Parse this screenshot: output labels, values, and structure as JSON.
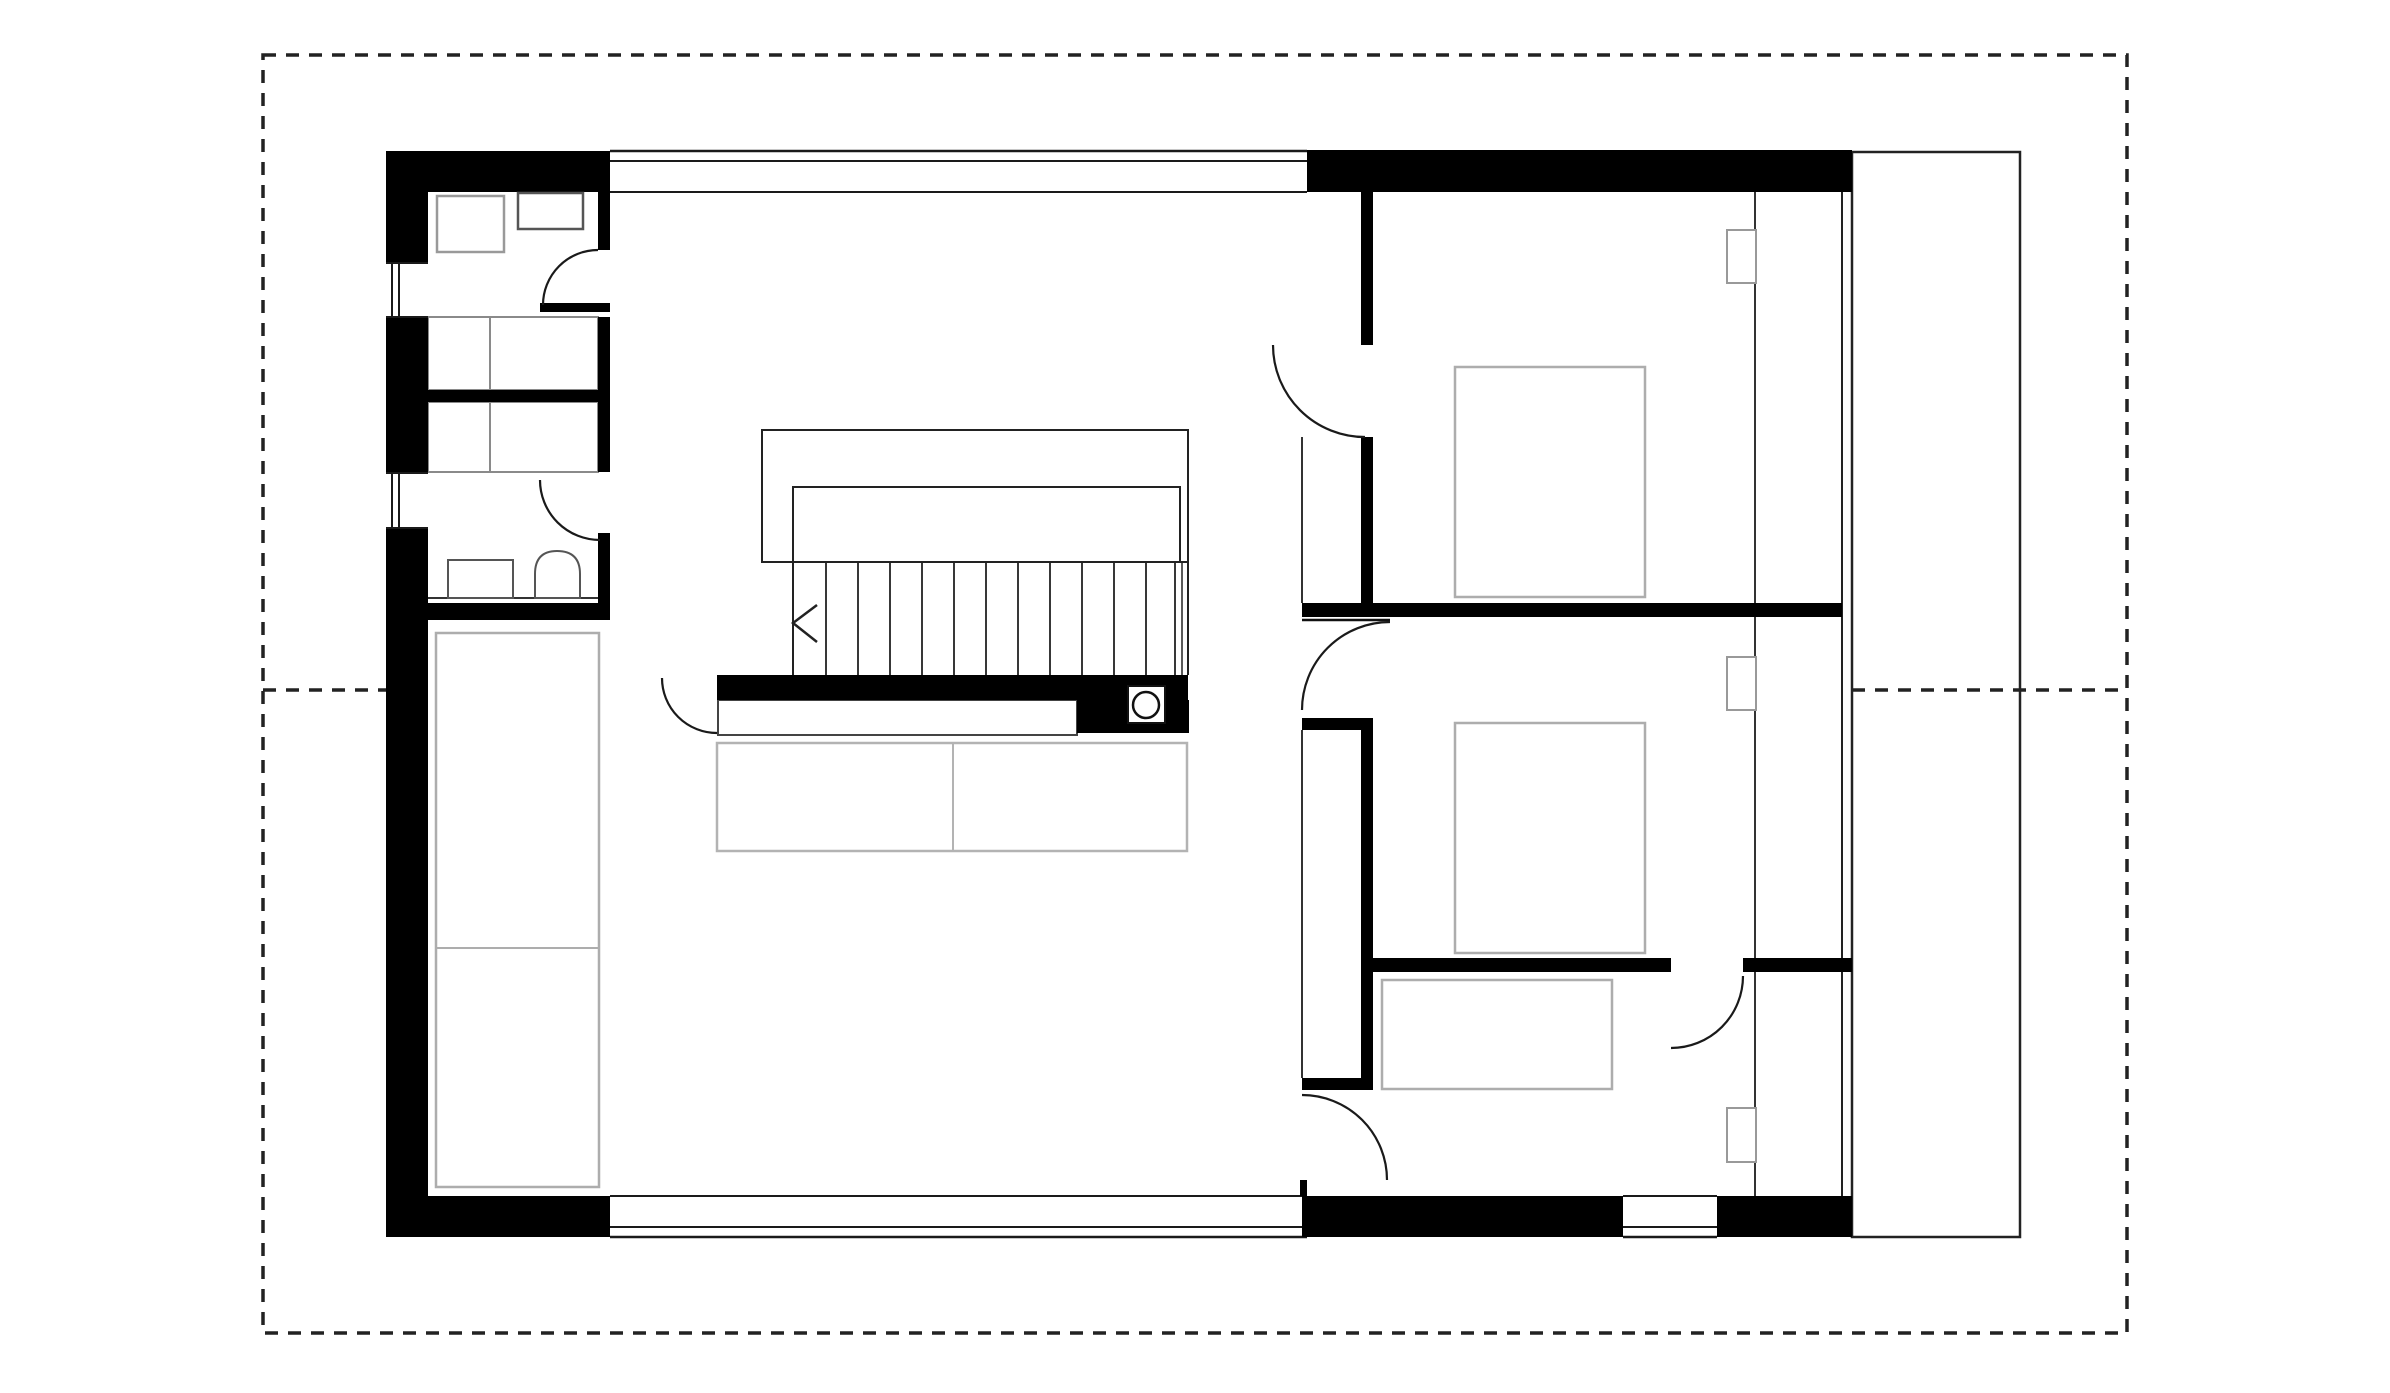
{
  "canvas": {
    "w": 2390,
    "h": 1393,
    "bg": "#ffffff"
  },
  "colors": {
    "wall": "#000000",
    "line": "#1a1a1a",
    "thin": "#333333",
    "dash": "#222222",
    "furniture_light": "#adadad",
    "furniture_mid": "#8a8a8a",
    "furniture_dark": "#555555"
  },
  "plan_meta": {
    "type": "architectural-floor-plan",
    "storey": "upper floor",
    "rooms": [
      "utility-room",
      "closets",
      "bathroom",
      "living-room",
      "stair-hall",
      "bedroom-top",
      "bedroom-middle",
      "bedroom-bottom",
      "terrace-strip"
    ]
  },
  "elements": [
    {
      "type": "rect",
      "name": "terrace-strip",
      "x": 1852,
      "y": 152,
      "w": 168,
      "h": 1085,
      "fill": "#ffffff",
      "stroke": "#222222",
      "sw": 2.5
    },
    {
      "type": "line",
      "name": "top-window-band-outer",
      "x1": 610,
      "y1": 151,
      "x2": 1307,
      "y2": 151,
      "stroke": "#1a1a1a",
      "sw": 2.5
    },
    {
      "type": "line",
      "name": "top-window-band-glass",
      "x1": 610,
      "y1": 161,
      "x2": 1307,
      "y2": 161,
      "stroke": "#1a1a1a",
      "sw": 2
    },
    {
      "type": "line",
      "name": "top-window-band-inner",
      "x1": 610,
      "y1": 192,
      "x2": 1307,
      "y2": 192,
      "stroke": "#1a1a1a",
      "sw": 2
    },
    {
      "type": "line",
      "name": "bottom-window-band-inner",
      "x1": 610,
      "y1": 1196,
      "x2": 1307,
      "y2": 1196,
      "stroke": "#1a1a1a",
      "sw": 2
    },
    {
      "type": "line",
      "name": "bottom-window-band-glass",
      "x1": 610,
      "y1": 1227,
      "x2": 1307,
      "y2": 1227,
      "stroke": "#1a1a1a",
      "sw": 2
    },
    {
      "type": "line",
      "name": "bottom-window-band-outer",
      "x1": 610,
      "y1": 1237,
      "x2": 1307,
      "y2": 1237,
      "stroke": "#1a1a1a",
      "sw": 2.5
    },
    {
      "type": "line",
      "name": "bottom-window-bedroom-inner",
      "x1": 1623,
      "y1": 1196,
      "x2": 1717,
      "y2": 1196,
      "stroke": "#1a1a1a",
      "sw": 2
    },
    {
      "type": "line",
      "name": "bottom-window-bedroom-glass",
      "x1": 1623,
      "y1": 1227,
      "x2": 1717,
      "y2": 1227,
      "stroke": "#1a1a1a",
      "sw": 2
    },
    {
      "type": "line",
      "name": "bottom-window-bedroom-outer",
      "x1": 1623,
      "y1": 1237,
      "x2": 1717,
      "y2": 1237,
      "stroke": "#1a1a1a",
      "sw": 2.5
    },
    {
      "type": "line",
      "name": "facade-inner-line",
      "x1": 1755,
      "y1": 192,
      "x2": 1755,
      "y2": 1196,
      "stroke": "#333333",
      "sw": 2
    },
    {
      "type": "line",
      "name": "facade-glass-line",
      "x1": 1842,
      "y1": 192,
      "x2": 1842,
      "y2": 1196,
      "stroke": "#222222",
      "sw": 2
    },
    {
      "type": "line",
      "name": "bedroom-closet-front-upper",
      "x1": 1302,
      "y1": 437,
      "x2": 1302,
      "y2": 603,
      "stroke": "#333333",
      "sw": 2
    },
    {
      "type": "line",
      "name": "bedroom-closet-front-lower",
      "x1": 1302,
      "y1": 730,
      "x2": 1302,
      "y2": 1078,
      "stroke": "#333333",
      "sw": 2
    },
    {
      "type": "path",
      "name": "stairs-outer-outline",
      "d": "M793,562 L762,562 L762,430 L1188,430 L1188,675",
      "stroke": "#222222",
      "sw": 2,
      "fill": "none"
    },
    {
      "type": "path",
      "name": "stairs-inner-outline",
      "d": "M793,675 L793,487 L1180,487 L1180,562",
      "stroke": "#222222",
      "sw": 2,
      "fill": "none"
    },
    {
      "type": "line",
      "name": "stairs-baseline",
      "x1": 762,
      "y1": 562,
      "x2": 1188,
      "y2": 562,
      "stroke": "#222222",
      "sw": 2
    },
    {
      "type": "line",
      "name": "stair-tread",
      "x1": 826,
      "y1": 562,
      "x2": 826,
      "y2": 675,
      "stroke": "#222222",
      "sw": 1.8
    },
    {
      "type": "line",
      "name": "stair-tread",
      "x1": 858,
      "y1": 562,
      "x2": 858,
      "y2": 675,
      "stroke": "#222222",
      "sw": 1.8
    },
    {
      "type": "line",
      "name": "stair-tread",
      "x1": 890,
      "y1": 562,
      "x2": 890,
      "y2": 675,
      "stroke": "#222222",
      "sw": 1.8
    },
    {
      "type": "line",
      "name": "stair-tread",
      "x1": 922,
      "y1": 562,
      "x2": 922,
      "y2": 675,
      "stroke": "#222222",
      "sw": 1.8
    },
    {
      "type": "line",
      "name": "stair-tread",
      "x1": 954,
      "y1": 562,
      "x2": 954,
      "y2": 675,
      "stroke": "#222222",
      "sw": 1.8
    },
    {
      "type": "line",
      "name": "stair-tread",
      "x1": 986,
      "y1": 562,
      "x2": 986,
      "y2": 675,
      "stroke": "#222222",
      "sw": 1.8
    },
    {
      "type": "line",
      "name": "stair-tread",
      "x1": 1018,
      "y1": 562,
      "x2": 1018,
      "y2": 675,
      "stroke": "#222222",
      "sw": 1.8
    },
    {
      "type": "line",
      "name": "stair-tread",
      "x1": 1050,
      "y1": 562,
      "x2": 1050,
      "y2": 675,
      "stroke": "#222222",
      "sw": 1.8
    },
    {
      "type": "line",
      "name": "stair-tread",
      "x1": 1082,
      "y1": 562,
      "x2": 1082,
      "y2": 675,
      "stroke": "#222222",
      "sw": 1.8
    },
    {
      "type": "line",
      "name": "stair-tread",
      "x1": 1114,
      "y1": 562,
      "x2": 1114,
      "y2": 675,
      "stroke": "#222222",
      "sw": 1.8
    },
    {
      "type": "line",
      "name": "stair-tread",
      "x1": 1146,
      "y1": 562,
      "x2": 1146,
      "y2": 675,
      "stroke": "#222222",
      "sw": 1.8
    },
    {
      "type": "line",
      "name": "stair-tread",
      "x1": 1175,
      "y1": 562,
      "x2": 1175,
      "y2": 675,
      "stroke": "#222222",
      "sw": 1.8
    },
    {
      "type": "line",
      "name": "stair-tread",
      "x1": 1182,
      "y1": 562,
      "x2": 1182,
      "y2": 675,
      "stroke": "#222222",
      "sw": 1.5
    },
    {
      "type": "polyline",
      "name": "stair-direction-arrow",
      "points": "817,605 793,623 817,642",
      "stroke": "#222222",
      "sw": 2.5,
      "fill": "none"
    },
    {
      "type": "rect",
      "name": "wardrobe-living",
      "x": 436,
      "y": 633,
      "w": 163,
      "h": 554,
      "fill": "none",
      "stroke": "#adadad",
      "sw": 2.5
    },
    {
      "type": "line",
      "name": "wardrobe-living-divider",
      "x1": 436,
      "y1": 948,
      "x2": 599,
      "y2": 948,
      "stroke": "#adadad",
      "sw": 2
    },
    {
      "type": "rect",
      "name": "sofa",
      "x": 717,
      "y": 743,
      "w": 470,
      "h": 108,
      "fill": "none",
      "stroke": "#b3b3b3",
      "sw": 2.5
    },
    {
      "type": "line",
      "name": "sofa-divider",
      "x1": 953,
      "y1": 743,
      "x2": 953,
      "y2": 851,
      "stroke": "#b3b3b3",
      "sw": 2
    },
    {
      "type": "rect",
      "name": "desk-bench",
      "x": 718,
      "y": 700,
      "w": 359,
      "h": 35,
      "fill": "#ffffff",
      "stroke": "#444444",
      "sw": 2
    },
    {
      "type": "rect",
      "name": "bed-top-bedroom",
      "x": 1455,
      "y": 367,
      "w": 190,
      "h": 230,
      "fill": "none",
      "stroke": "#adadad",
      "sw": 2.5
    },
    {
      "type": "rect",
      "name": "bed-middle-bedroom",
      "x": 1455,
      "y": 723,
      "w": 190,
      "h": 230,
      "fill": "none",
      "stroke": "#adadad",
      "sw": 2.5
    },
    {
      "type": "rect",
      "name": "bed-bottom-bedroom",
      "x": 1382,
      "y": 980,
      "w": 230,
      "h": 109,
      "fill": "none",
      "stroke": "#adadad",
      "sw": 2.5
    },
    {
      "type": "rect",
      "name": "closet-a-outline",
      "x": 428,
      "y": 317,
      "w": 170,
      "h": 73,
      "fill": "none",
      "stroke": "#8a8a8a",
      "sw": 2
    },
    {
      "type": "line",
      "name": "closet-a-divider",
      "x1": 490,
      "y1": 317,
      "x2": 490,
      "y2": 390,
      "stroke": "#8a8a8a",
      "sw": 2
    },
    {
      "type": "rect",
      "name": "closet-b-outline",
      "x": 428,
      "y": 402,
      "w": 170,
      "h": 70,
      "fill": "none",
      "stroke": "#8a8a8a",
      "sw": 2
    },
    {
      "type": "line",
      "name": "closet-b-divider",
      "x1": 490,
      "y1": 402,
      "x2": 490,
      "y2": 472,
      "stroke": "#8a8a8a",
      "sw": 2
    },
    {
      "type": "rect",
      "name": "wall-left-upper",
      "x": 386,
      "y": 151,
      "w": 42,
      "h": 112,
      "fill": "#000000"
    },
    {
      "type": "rect",
      "name": "wall-left-middle",
      "x": 386,
      "y": 317,
      "w": 42,
      "h": 156,
      "fill": "#000000"
    },
    {
      "type": "rect",
      "name": "wall-left-lower",
      "x": 386,
      "y": 528,
      "w": 42,
      "h": 709,
      "fill": "#000000"
    },
    {
      "type": "rect",
      "name": "wall-top-left-wing",
      "x": 386,
      "y": 151,
      "w": 224,
      "h": 41,
      "fill": "#000000"
    },
    {
      "type": "rect",
      "name": "wall-top-right-wing",
      "x": 1307,
      "y": 150,
      "w": 545,
      "h": 42,
      "fill": "#000000"
    },
    {
      "type": "rect",
      "name": "wall-bottom-left",
      "x": 386,
      "y": 1196,
      "w": 224,
      "h": 41,
      "fill": "#000000"
    },
    {
      "type": "rect",
      "name": "wall-bottom-middle",
      "x": 1302,
      "y": 1196,
      "w": 321,
      "h": 41,
      "fill": "#000000"
    },
    {
      "type": "rect",
      "name": "wall-bottom-right",
      "x": 1717,
      "y": 1196,
      "w": 135,
      "h": 41,
      "fill": "#000000"
    },
    {
      "type": "rect",
      "name": "utility-right-wall",
      "x": 598,
      "y": 192,
      "w": 12,
      "h": 58,
      "fill": "#000000"
    },
    {
      "type": "rect",
      "name": "utility-door-stub",
      "x": 540,
      "y": 303,
      "w": 70,
      "h": 9,
      "fill": "#000000"
    },
    {
      "type": "rect",
      "name": "closet-a-right-stub",
      "x": 598,
      "y": 317,
      "w": 12,
      "h": 73,
      "fill": "#000000"
    },
    {
      "type": "rect",
      "name": "closet-band-wall",
      "x": 428,
      "y": 390,
      "w": 182,
      "h": 12,
      "fill": "#000000"
    },
    {
      "type": "rect",
      "name": "closet-b-right-stub",
      "x": 598,
      "y": 402,
      "w": 12,
      "h": 70,
      "fill": "#000000"
    },
    {
      "type": "rect",
      "name": "bathroom-right-wall",
      "x": 598,
      "y": 533,
      "w": 12,
      "h": 70,
      "fill": "#000000"
    },
    {
      "type": "rect",
      "name": "bathroom-bottom-wall",
      "x": 386,
      "y": 603,
      "w": 224,
      "h": 17,
      "fill": "#000000"
    },
    {
      "type": "rect",
      "name": "understair-wall",
      "x": 717,
      "y": 675,
      "w": 471,
      "h": 25,
      "fill": "#000000"
    },
    {
      "type": "rect",
      "name": "understair-block",
      "x": 1077,
      "y": 700,
      "w": 112,
      "h": 33,
      "fill": "#000000"
    },
    {
      "type": "rect",
      "name": "bedroom-west-wall-upper",
      "x": 1361,
      "y": 192,
      "w": 12,
      "h": 153,
      "fill": "#000000"
    },
    {
      "type": "rect",
      "name": "bedroom-west-wall-mid",
      "x": 1361,
      "y": 437,
      "w": 12,
      "h": 166,
      "fill": "#000000"
    },
    {
      "type": "rect",
      "name": "wall-h1-bedrooms",
      "x": 1302,
      "y": 603,
      "w": 540,
      "h": 14,
      "fill": "#000000"
    },
    {
      "type": "rect",
      "name": "bedroom-west-cap-top",
      "x": 1302,
      "y": 718,
      "w": 71,
      "h": 12,
      "fill": "#000000"
    },
    {
      "type": "rect",
      "name": "bedroom-west-wall-lower",
      "x": 1361,
      "y": 718,
      "w": 12,
      "h": 360,
      "fill": "#000000"
    },
    {
      "type": "rect",
      "name": "bedroom-west-cap-bottom",
      "x": 1302,
      "y": 1078,
      "w": 71,
      "h": 12,
      "fill": "#000000"
    },
    {
      "type": "rect",
      "name": "bottom-door-stub",
      "x": 1300,
      "y": 1180,
      "w": 7,
      "h": 16,
      "fill": "#000000"
    },
    {
      "type": "rect",
      "name": "wall-h2-left",
      "x": 1373,
      "y": 958,
      "w": 298,
      "h": 14,
      "fill": "#000000"
    },
    {
      "type": "rect",
      "name": "wall-h2-right",
      "x": 1743,
      "y": 958,
      "w": 109,
      "h": 14,
      "fill": "#000000"
    },
    {
      "type": "rect",
      "name": "window-left-1-bg",
      "x": 386,
      "y": 263,
      "w": 42,
      "h": 54,
      "fill": "#ffffff"
    },
    {
      "type": "line",
      "name": "window-left-1-edge-top",
      "x1": 386,
      "y1": 263,
      "x2": 428,
      "y2": 263,
      "stroke": "#1a1a1a",
      "sw": 2
    },
    {
      "type": "line",
      "name": "window-left-1-edge-bottom",
      "x1": 386,
      "y1": 317,
      "x2": 428,
      "y2": 317,
      "stroke": "#1a1a1a",
      "sw": 2
    },
    {
      "type": "line",
      "name": "window-left-1-glass-a",
      "x1": 392,
      "y1": 263,
      "x2": 392,
      "y2": 317,
      "stroke": "#1a1a1a",
      "sw": 2
    },
    {
      "type": "line",
      "name": "window-left-1-glass-b",
      "x1": 399,
      "y1": 263,
      "x2": 399,
      "y2": 317,
      "stroke": "#1a1a1a",
      "sw": 2
    },
    {
      "type": "rect",
      "name": "window-left-2-bg",
      "x": 386,
      "y": 473,
      "w": 42,
      "h": 55,
      "fill": "#ffffff"
    },
    {
      "type": "line",
      "name": "window-left-2-edge-top",
      "x1": 386,
      "y1": 473,
      "x2": 428,
      "y2": 473,
      "stroke": "#1a1a1a",
      "sw": 2
    },
    {
      "type": "line",
      "name": "window-left-2-edge-bottom",
      "x1": 386,
      "y1": 528,
      "x2": 428,
      "y2": 528,
      "stroke": "#1a1a1a",
      "sw": 2
    },
    {
      "type": "line",
      "name": "window-left-2-glass-a",
      "x1": 392,
      "y1": 473,
      "x2": 392,
      "y2": 528,
      "stroke": "#1a1a1a",
      "sw": 2
    },
    {
      "type": "line",
      "name": "window-left-2-glass-b",
      "x1": 399,
      "y1": 473,
      "x2": 399,
      "y2": 528,
      "stroke": "#1a1a1a",
      "sw": 2
    },
    {
      "type": "rect",
      "name": "utility-appliance",
      "x": 437,
      "y": 196,
      "w": 67,
      "h": 56,
      "fill": "#ffffff",
      "stroke": "#999999",
      "sw": 2.5
    },
    {
      "type": "rect",
      "name": "utility-cabinet",
      "x": 518,
      "y": 193,
      "w": 65,
      "h": 36,
      "fill": "#ffffff",
      "stroke": "#555555",
      "sw": 2.5
    },
    {
      "type": "line",
      "name": "bathroom-counter",
      "x1": 428,
      "y1": 598,
      "x2": 598,
      "y2": 598,
      "stroke": "#333333",
      "sw": 2
    },
    {
      "type": "rect",
      "name": "washbasin",
      "x": 448,
      "y": 560,
      "w": 65,
      "h": 38,
      "fill": "#ffffff",
      "stroke": "#555555",
      "sw": 2
    },
    {
      "type": "path",
      "name": "toilet",
      "d": "M535,598 L535,574 Q535,551 557,551 Q580,551 580,574 L580,598 Z",
      "fill": "#ffffff",
      "stroke": "#555555",
      "sw": 2
    },
    {
      "type": "rect",
      "name": "niche-top",
      "x": 1727,
      "y": 230,
      "w": 29,
      "h": 53,
      "fill": "#ffffff",
      "stroke": "#999999",
      "sw": 2
    },
    {
      "type": "rect",
      "name": "niche-middle",
      "x": 1727,
      "y": 657,
      "w": 29,
      "h": 53,
      "fill": "#ffffff",
      "stroke": "#999999",
      "sw": 2
    },
    {
      "type": "rect",
      "name": "niche-bottom",
      "x": 1727,
      "y": 1108,
      "w": 29,
      "h": 54,
      "fill": "#ffffff",
      "stroke": "#999999",
      "sw": 2
    },
    {
      "type": "path",
      "name": "door-arc-utility",
      "d": "M598,250 A55,55 0 0 0 543,305",
      "stroke": "#1a1a1a",
      "sw": 2.2,
      "fill": "none"
    },
    {
      "type": "path",
      "name": "door-arc-bathroom",
      "d": "M540,480 A60,60 0 0 0 600,540",
      "stroke": "#1a1a1a",
      "sw": 2.2,
      "fill": "none"
    },
    {
      "type": "path",
      "name": "door-arc-living-hall",
      "d": "M662,678 A55,55 0 0 0 717,733",
      "stroke": "#1a1a1a",
      "sw": 2.2,
      "fill": "none"
    },
    {
      "type": "path",
      "name": "door-arc-bedroom-top",
      "d": "M1273,345 A92,92 0 0 0 1365,437",
      "stroke": "#1a1a1a",
      "sw": 2.2,
      "fill": "none"
    },
    {
      "type": "line",
      "name": "door-leaf-bedroom-middle",
      "x1": 1302,
      "y1": 620,
      "x2": 1390,
      "y2": 620,
      "stroke": "#111111",
      "sw": 2.5
    },
    {
      "type": "path",
      "name": "door-arc-bedroom-middle",
      "d": "M1390,622 A88,88 0 0 0 1302,710",
      "stroke": "#1a1a1a",
      "sw": 2.2,
      "fill": "none"
    },
    {
      "type": "path",
      "name": "door-arc-bedroom-bottom-hall",
      "d": "M1302,1095 A85,85 0 0 1 1387,1180",
      "stroke": "#1a1a1a",
      "sw": 2.2,
      "fill": "none"
    },
    {
      "type": "path",
      "name": "door-arc-bedroom-bottom-room",
      "d": "M1743,976 A72,72 0 0 1 1671,1048",
      "stroke": "#1a1a1a",
      "sw": 2.2,
      "fill": "none"
    },
    {
      "type": "rect",
      "name": "flue-box",
      "x": 1128,
      "y": 686,
      "w": 37,
      "h": 37,
      "fill": "#ffffff",
      "stroke": "#111111",
      "sw": 2
    },
    {
      "type": "circle",
      "name": "flue-circle",
      "cx": 1146,
      "cy": 705,
      "r": 13,
      "fill": "#ffffff",
      "stroke": "#111111",
      "sw": 2.5
    },
    {
      "type": "rect",
      "name": "print-border",
      "x": 263,
      "y": 55,
      "w": 1864,
      "h": 1278,
      "fill": "none",
      "stroke": "#222222",
      "sw": 3.5,
      "dash": "13 10"
    },
    {
      "type": "line",
      "name": "section-line-left",
      "x1": 263,
      "y1": 690,
      "x2": 386,
      "y2": 690,
      "stroke": "#222222",
      "sw": 3.5,
      "dash": "13 10"
    },
    {
      "type": "line",
      "name": "section-line-right",
      "x1": 1852,
      "y1": 690,
      "x2": 2127,
      "y2": 690,
      "stroke": "#222222",
      "sw": 3.5,
      "dash": "13 10"
    }
  ]
}
